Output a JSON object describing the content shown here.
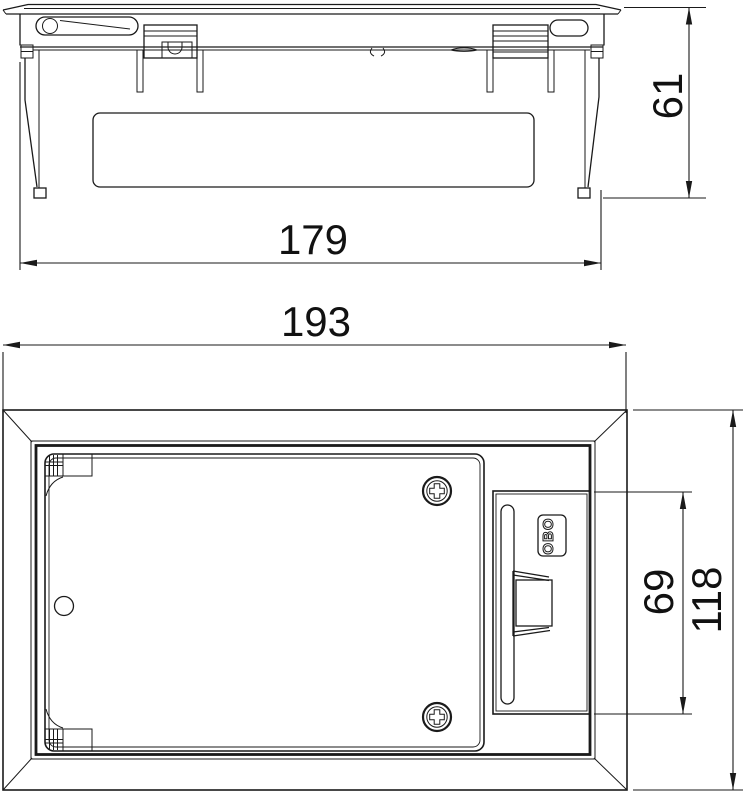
{
  "drawing": {
    "background_color": "#ffffff",
    "line_color": "#1a1a1a",
    "elevation": {
      "height_dim": "61",
      "width_dim": "179"
    },
    "plan": {
      "width_dim": "193",
      "inset_height_dim": "69",
      "height_dim": "118",
      "badge_text": "OBO"
    }
  }
}
